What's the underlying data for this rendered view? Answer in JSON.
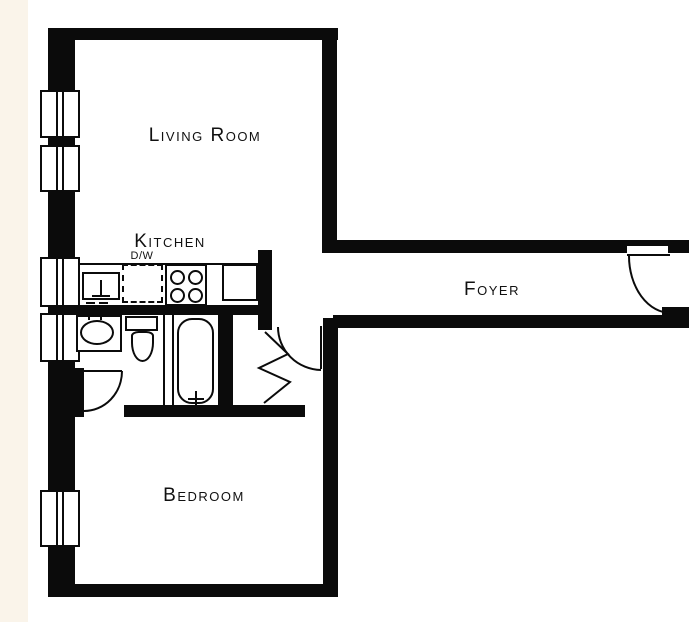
{
  "plan": {
    "type": "apartment-floor-plan",
    "colors": {
      "wall": "#0b0b0b",
      "floor": "#ffffff",
      "margin": "#faf4ea",
      "ink": "#111111"
    },
    "rooms": {
      "living_room": {
        "label": "Living Room"
      },
      "kitchen": {
        "label": "Kitchen"
      },
      "foyer": {
        "label": "Foyer"
      },
      "bedroom": {
        "label": "Bedroom"
      },
      "dishwasher_tag": {
        "label": "D/W"
      }
    },
    "fixtures": [
      "kitchen-sink",
      "dishwasher",
      "stove-four-burners",
      "base-cabinet",
      "vanity-sink",
      "toilet",
      "bathtub"
    ],
    "windows_count": 5,
    "doors": [
      "entry-door",
      "hall-door",
      "bathroom-door",
      "accordion-closet-door"
    ]
  }
}
